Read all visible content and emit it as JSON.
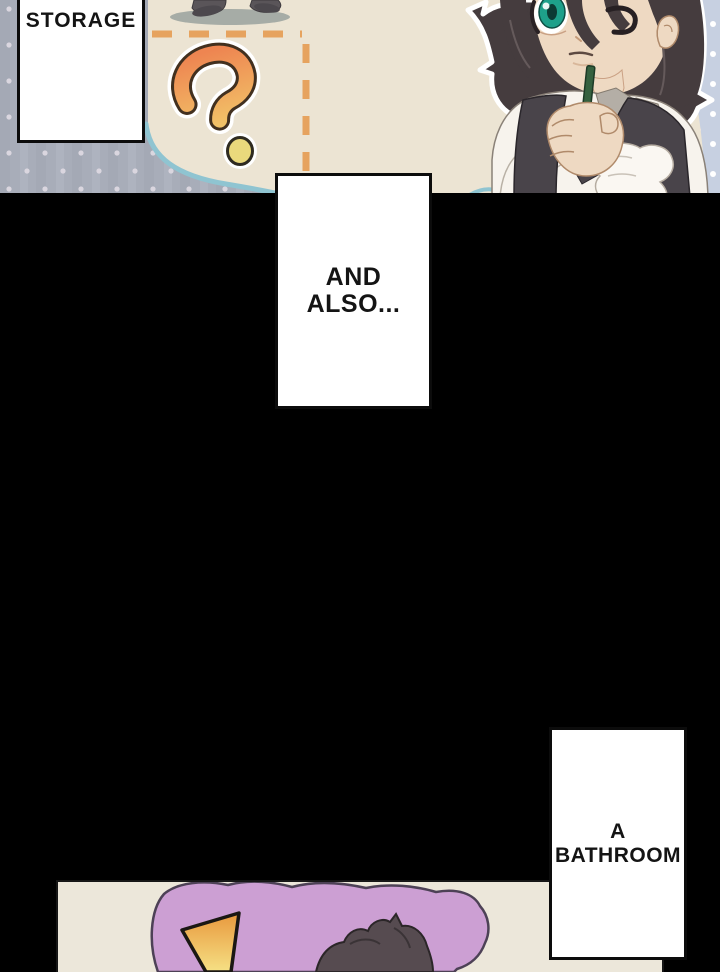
{
  "page": {
    "kind": "webtoon-comic-page",
    "background_color": "#000000"
  },
  "panels": {
    "top_panel": {
      "speech_box": {
        "text": "STORAGE"
      },
      "floor_plan": {
        "question_mark_glyph": "?",
        "colors": {
          "floor": "#ece4d3",
          "dots_bg": "#a8adb9",
          "dots": "#dad6df",
          "corner_bg": "#c7d0e1",
          "dash_orange": "#e6a35f",
          "curve_teal": "#8fc4d1",
          "qm_gradient_top": "#ee8551",
          "qm_gradient_bottom": "#f2c368",
          "qm_outline": "#42301f",
          "qm_halo": "#ffffff",
          "qm_dot_fill": "#ead97c",
          "legs_fill": "#5a5559",
          "shadow": "#9aa29e"
        }
      },
      "character": {
        "colors": {
          "hair": "#453c3e",
          "hair_outline": "#ffffff",
          "skin": "#eed9c2",
          "eye_iris": "#1ea08a",
          "shirt": "#f7f3ed",
          "vest": "#49444a",
          "collar": "#b4aea6",
          "pencil": "#35613f"
        }
      }
    },
    "narration_boxes": [
      {
        "id": "and_also",
        "text": "AND ALSO..."
      },
      {
        "id": "a_bathroom",
        "text": "A BATHROOM"
      }
    ],
    "bottom_panel": {
      "exclamation_glyph": "!",
      "colors": {
        "floor": "#ece7da",
        "blob_fill": "#cc9fd3",
        "blob_outline": "#4d4156",
        "excl_gradient_top": "#e8973c",
        "excl_gradient_bottom": "#f6e387",
        "excl_outline": "#1a1713",
        "hair": "#564b50"
      }
    }
  }
}
